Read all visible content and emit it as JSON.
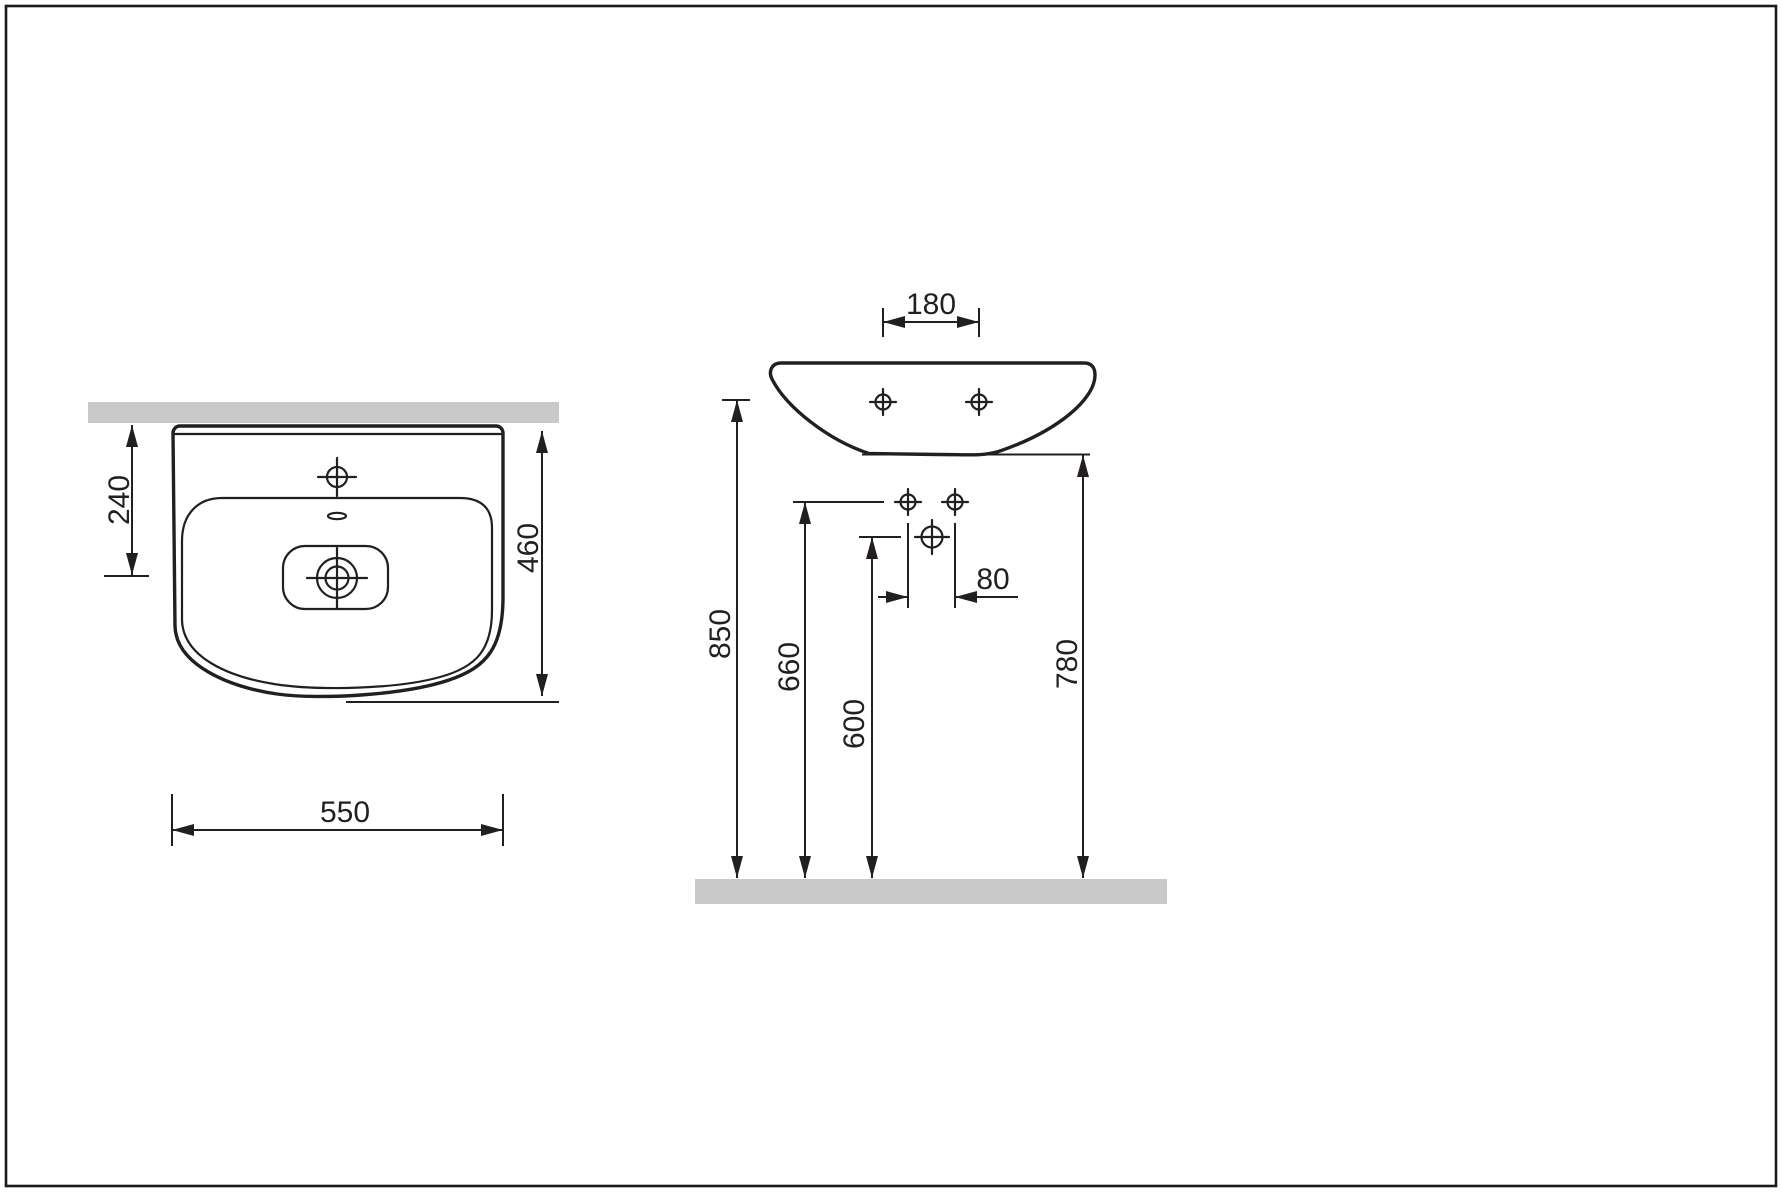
{
  "drawing": {
    "type": "washbasin technical dimension drawing",
    "colors": {
      "line": "#231f20",
      "surface": "#c9c9c9",
      "background": "#ffffff",
      "frame": "#1a1a1a"
    },
    "top_view": {
      "dim_wall_to_drain": "240",
      "dim_depth": "460",
      "dim_width": "550"
    },
    "front_view": {
      "dim_tap_hole_spacing": "180",
      "dim_fixing_hole_spacing": "80",
      "dim_rim_height": "850",
      "dim_fixing_holes_height": "660",
      "dim_drain_height": "600",
      "dim_underside_height": "780"
    }
  }
}
